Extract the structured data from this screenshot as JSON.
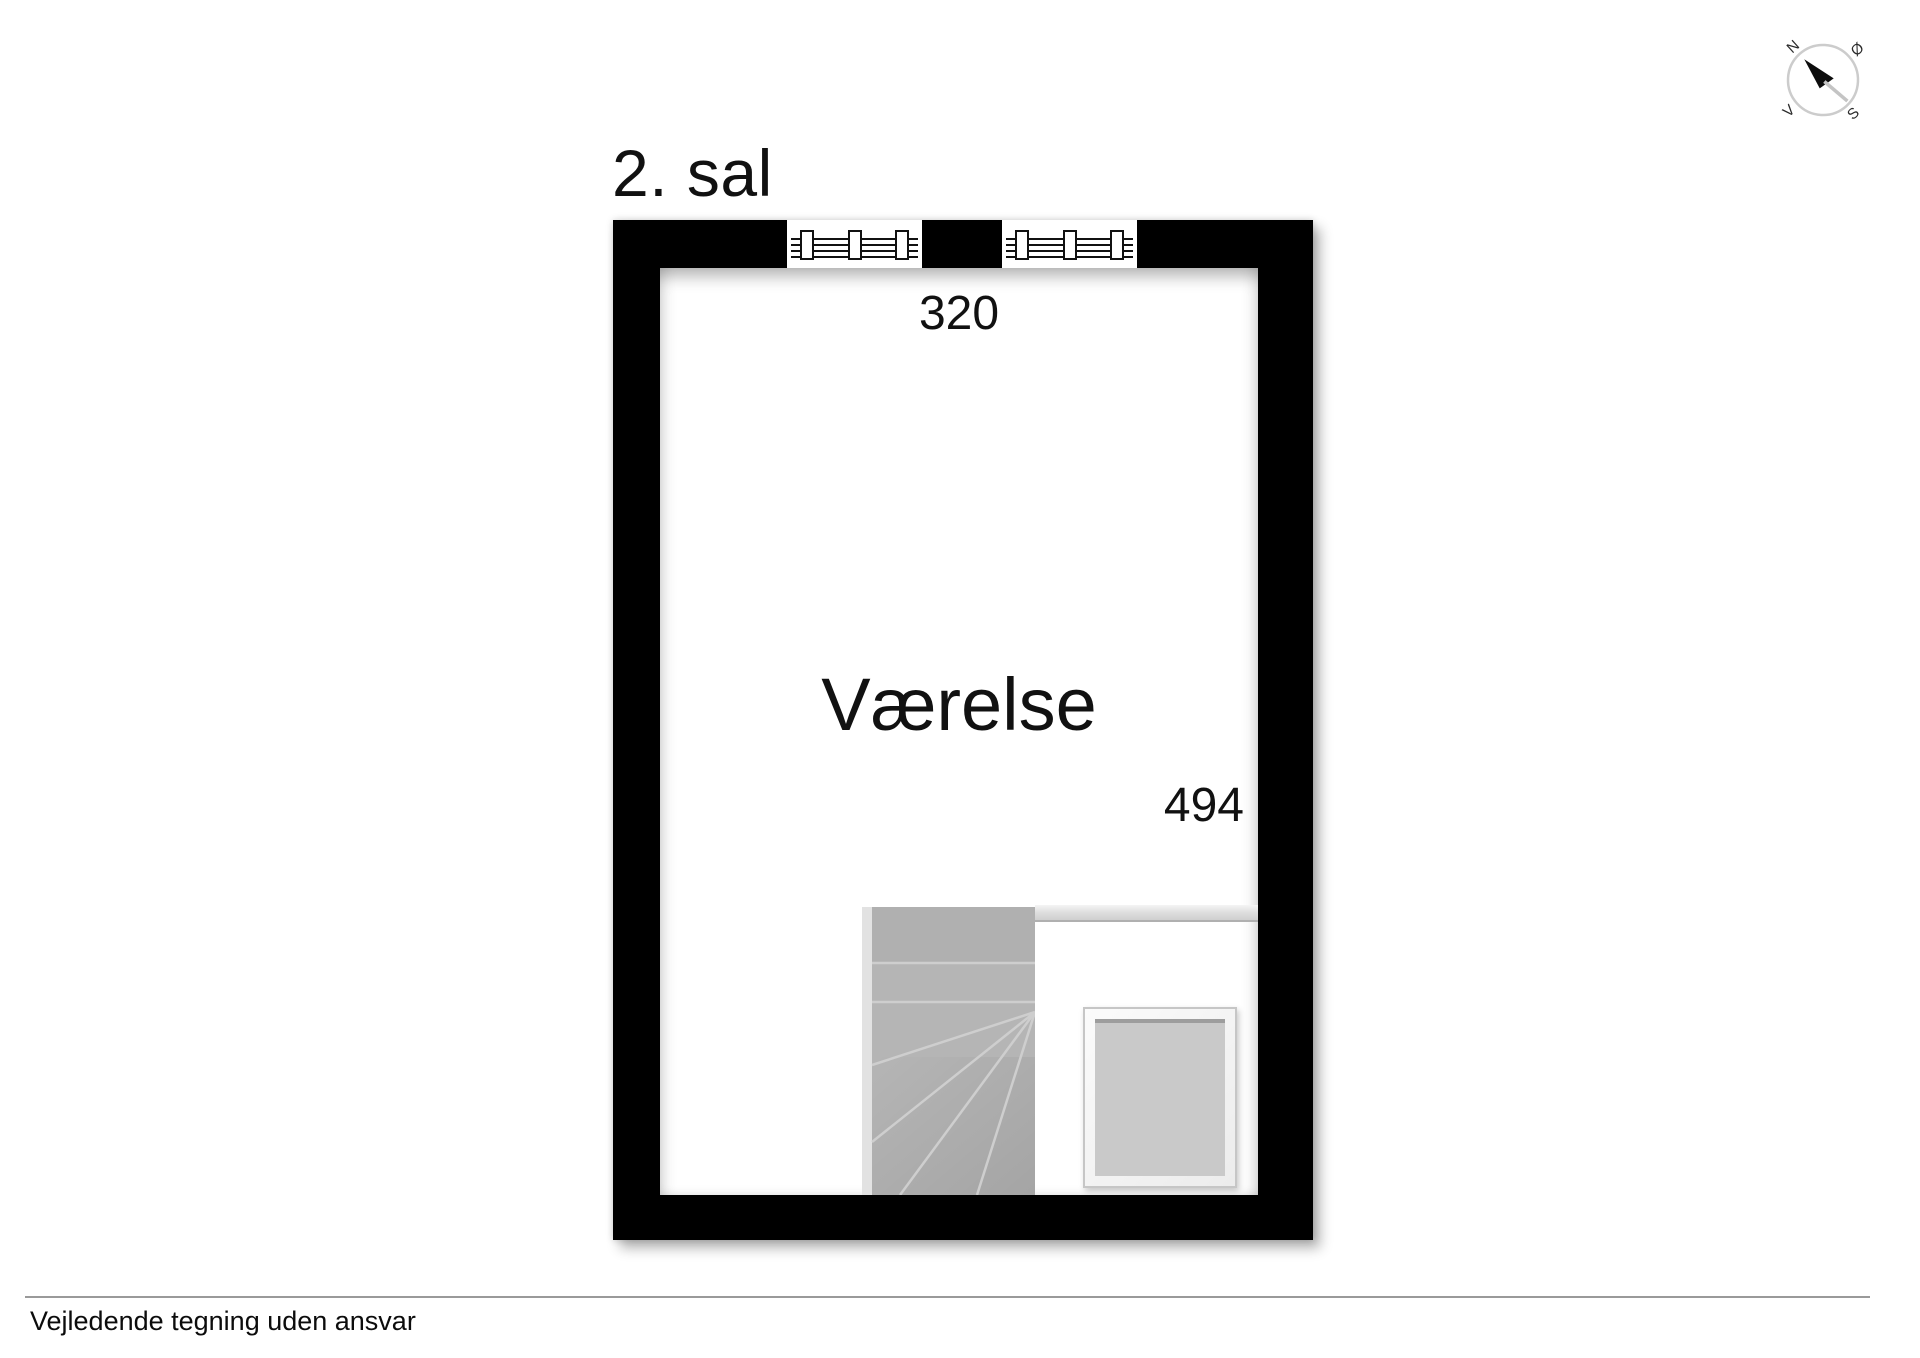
{
  "floor_title": "2. sal",
  "room": {
    "name": "Værelse",
    "width_cm": "320",
    "depth_cm": "494"
  },
  "compass": {
    "north": "N",
    "east": "Ø",
    "south": "S",
    "west": "V"
  },
  "footer": {
    "disclaimer": "Vejledende tegning uden ansvar"
  },
  "colors": {
    "wall": "#000000",
    "floor": "#ffffff",
    "stair_fill": "#b4b4b4",
    "stair_line": "#cccccc",
    "object_fill": "#c9c9c9",
    "divider_line": "#9a9a9a",
    "compass_ring": "#cccccc"
  }
}
